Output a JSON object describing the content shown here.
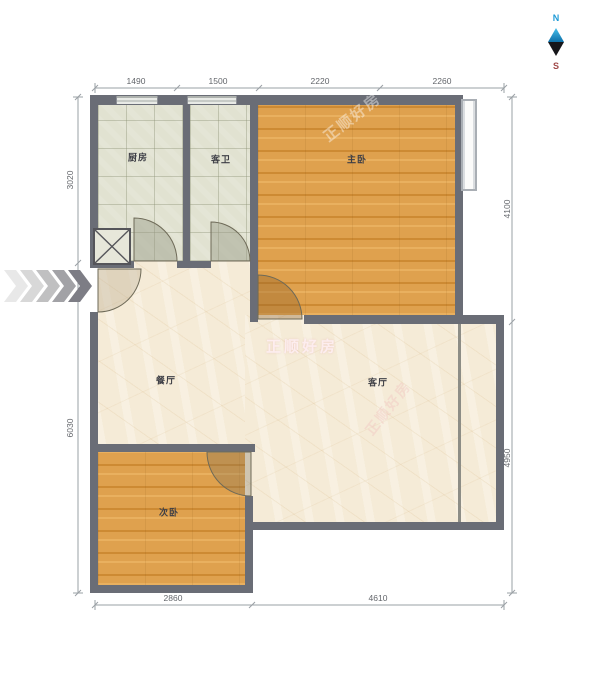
{
  "compass": {
    "north": "N",
    "south": "S"
  },
  "rooms": {
    "kitchen": "厨房",
    "guest_bath": "客卫",
    "master_bedroom": "主卧",
    "dining": "餐厅",
    "living": "客厅",
    "second_bedroom": "次卧"
  },
  "dimensions": {
    "top": [
      "1490",
      "1500",
      "2220",
      "2260"
    ],
    "left": [
      "3020",
      "6030"
    ],
    "right": [
      "4100",
      "4950"
    ],
    "bottom": [
      "2860",
      "4610"
    ]
  },
  "watermarks": {
    "center": "正顺好房",
    "diagonal_master": "正顺好房",
    "diagonal_living": "正顺好房"
  },
  "colors": {
    "wall": "#6a6d76",
    "wood_floor": "#dfa14e",
    "tile_floor": "#e1e2d1",
    "marble_floor": "#f5ebd7",
    "compass_north": "#1f9ad6",
    "compass_south": "#a04848",
    "watermark": "#fdeef0"
  }
}
